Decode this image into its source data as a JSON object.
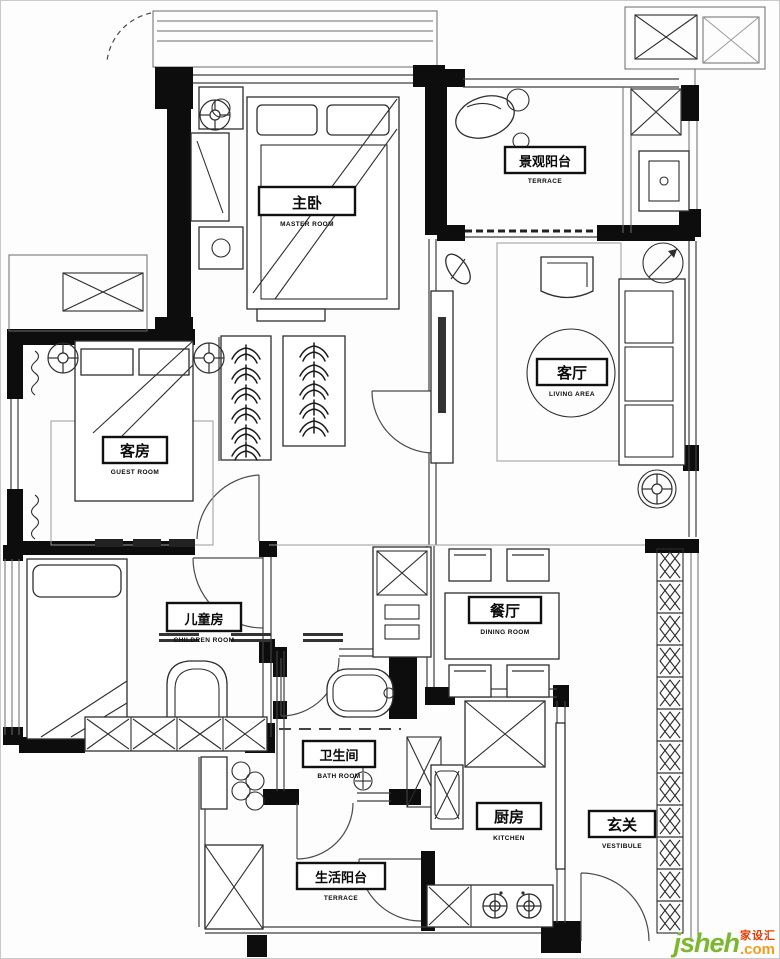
{
  "colors": {
    "wall": "#0d0d0d",
    "line": "#3f3f3f",
    "brand_green": "#7cb82f",
    "brand_orange": "#f59b1e",
    "brand_red": "#e03a00"
  },
  "icons": {
    "ceiling_fan": "circle-with-spokes",
    "clothes_hanger": "fishbone-arcs",
    "lattice_screen": "diamond-x-cells",
    "stove_burner": "concentric-circles"
  },
  "rooms": {
    "master": {
      "zh": "主卧",
      "en": "MASTER ROOM"
    },
    "view_balcony": {
      "zh": "景观阳台",
      "en": "TERRACE"
    },
    "living": {
      "zh": "客厅",
      "en": "LIVING AREA"
    },
    "guest": {
      "zh": "客房",
      "en": "GUEST ROOM"
    },
    "children": {
      "zh": "儿童房",
      "en": "CHILDREN ROOM"
    },
    "dining": {
      "zh": "餐厅",
      "en": "DINING ROOM"
    },
    "bath": {
      "zh": "卫生间",
      "en": "BATH ROOM"
    },
    "kitchen": {
      "zh": "厨房",
      "en": "KITCHEN"
    },
    "vestibule": {
      "zh": "玄关",
      "en": "VESTIBULE"
    },
    "life_balcony": {
      "zh": "生活阳台",
      "en": "TERRACE"
    }
  },
  "watermark": {
    "brand": "jsheh",
    "tld": ".com",
    "cn": "家设汇"
  }
}
